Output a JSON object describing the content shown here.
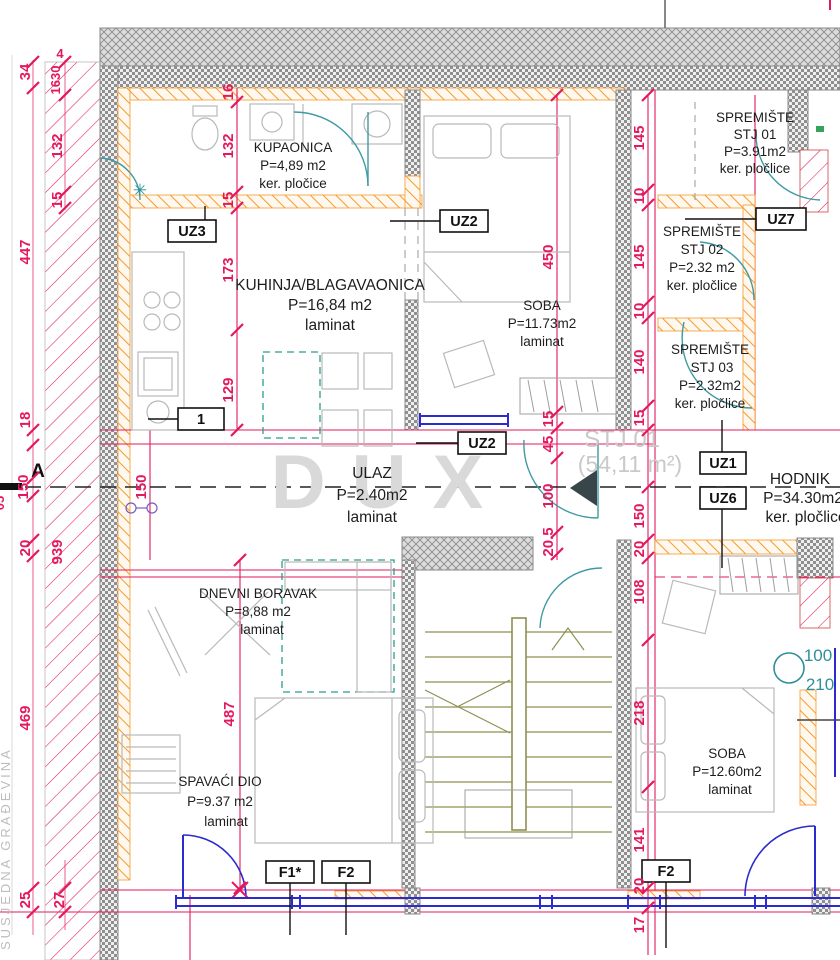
{
  "rooms": [
    {
      "name": "KUPAONICA",
      "area": "P=4,89 m2",
      "floor": "ker. pločice"
    },
    {
      "name": "KUHINJA/BLAGAVAONICA",
      "area": "P=16,84 m2",
      "floor": "laminat"
    },
    {
      "name": "SOBA",
      "area": "P=11.73m2",
      "floor": "laminat"
    },
    {
      "name": "SPREMIŠTE",
      "unit": "STJ 01",
      "area": "P=3.91m2",
      "floor": "ker. pločlice"
    },
    {
      "name": "SPREMIŠTE",
      "unit": "STJ 02",
      "area": "P=2.32 m2",
      "floor": "ker. pločlice"
    },
    {
      "name": "SPREMIŠTE",
      "unit": "STJ 03",
      "area": "P=2.32m2",
      "floor": "ker. pločlice"
    },
    {
      "name": "ULAZ",
      "area": "P=2.40m2",
      "floor": "laminat"
    },
    {
      "name": "HODNIK",
      "area": "P=34.30m2",
      "floor": "ker. pločlice"
    },
    {
      "name": "DNEVNI BORAVAK",
      "area": "P=8,88 m2",
      "floor": "laminat"
    },
    {
      "name": "SPAVAĆI DIO",
      "area": "P=9.37 m2",
      "floor": "laminat"
    },
    {
      "name": "SOBA",
      "area": "P=12.60m2",
      "floor": "laminat"
    }
  ],
  "tags": {
    "uz3": "UZ3",
    "uz2_top": "UZ2",
    "uz2_mid": "UZ2",
    "uz7": "UZ7",
    "uz1": "UZ1",
    "uz6": "UZ6",
    "one": "1",
    "f1": "F1*",
    "f2_left": "F2",
    "f2_right": "F2"
  },
  "dims": {
    "l34": "34",
    "l447": "447",
    "l18": "18",
    "l150": "150",
    "l20": "20",
    "l469": "469",
    "l25": "25",
    "b4": "4",
    "b1630": "1630",
    "b132": "132",
    "b15": "15",
    "b939": "939",
    "b27": "27",
    "c16": "16",
    "c132": "132",
    "c15": "15",
    "c173": "173",
    "c129": "129",
    "c487": "487",
    "k150": "150",
    "d450": "450",
    "d15": "15",
    "d45": "45",
    "d100": "100",
    "d205": "20.5",
    "e145a": "145",
    "e10a": "10",
    "e145b": "145",
    "e10b": "10",
    "e140": "140",
    "e15": "15",
    "e150": "150",
    "e20": "20",
    "e108": "108",
    "e218": "218",
    "e141": "141",
    "e20b": "20",
    "e17": "17",
    "clip": "05"
  },
  "annotations": {
    "section_letter": "A",
    "neighbor_label": "SUSJEDNA GRAĐEVINA",
    "door_circle": {
      "width": "100",
      "height": "210"
    },
    "watermark": {
      "brand": "DUX",
      "unit": "STJ 01",
      "area": "(54,11 m²)"
    },
    "drain_symbol": "✳"
  },
  "colors": {
    "dimension": "#e3195f",
    "wall_dark": "#8a8a8a",
    "wall_orange": "#f49a2e",
    "stairs": "#8f8f52",
    "door": "#3f9aa3",
    "window": "#2b2bd0",
    "furniture": "#b9b9b9"
  }
}
